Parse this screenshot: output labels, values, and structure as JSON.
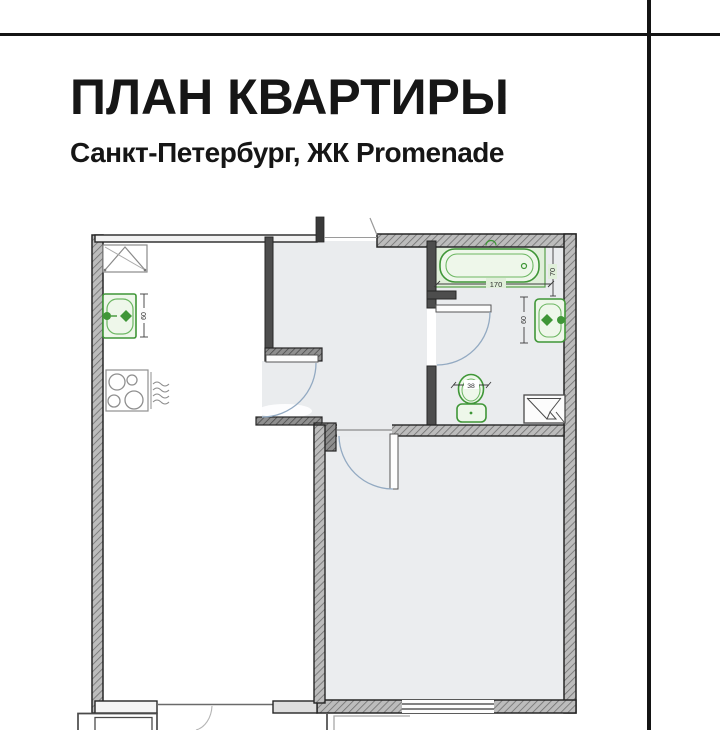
{
  "header": {
    "title": "ПЛАН КВАРТИРЫ",
    "subtitle_prefix": "Санкт-Петербург, ЖК ",
    "subtitle_brand": "Promenade"
  },
  "plan": {
    "dimensions": {
      "bathtub_length": "170",
      "bathtub_width": "70",
      "washbasin_width": "60",
      "kitchen_sink_width": "60",
      "toilet_width": "38"
    },
    "icons": [
      "bathtub-icon",
      "washbasin-icon",
      "toilet-icon",
      "kitchen-sink-icon",
      "stove-icon",
      "shower-tray-icon",
      "corner-cabinet-icon",
      "door-swing-icon"
    ],
    "colors": {
      "fixture_green": "#3f9637",
      "fixture_fill": "#eef7ea",
      "tub_surround": "#e0efda",
      "floor_gray": "#eaecee",
      "wall_edge": "#262626",
      "door_arc_blue": "#93aac2",
      "frame_line": "#141414"
    }
  }
}
